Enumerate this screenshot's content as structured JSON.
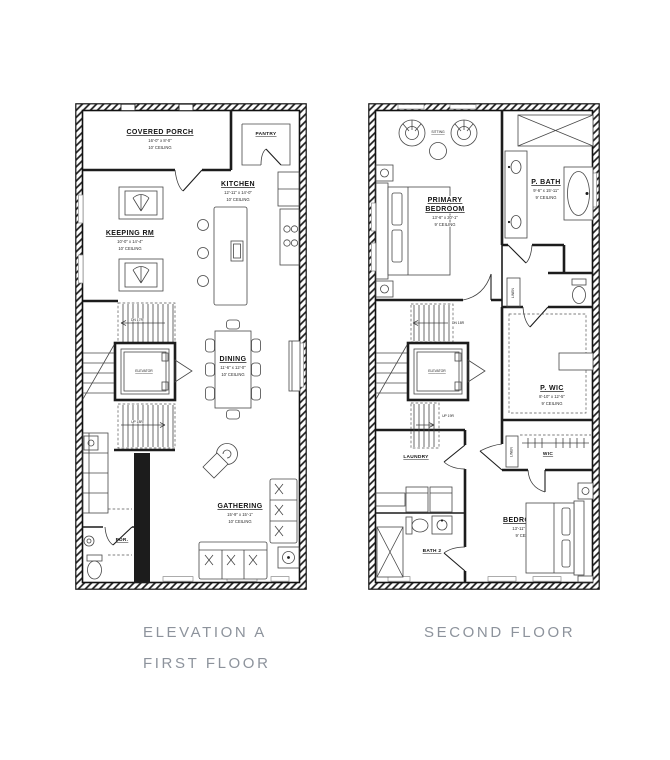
{
  "captions": {
    "elevation": "ELEVATION A",
    "first_floor": "FIRST FLOOR",
    "second_floor": "SECOND FLOOR",
    "color": "#8d939c"
  },
  "colors": {
    "line": "#1c1c1c",
    "background": "#ffffff"
  },
  "first_floor": {
    "covered_porch": {
      "name": "COVERED PORCH",
      "dims": "16'-0\" x 8'-0\"",
      "ceiling": "10' CEILING"
    },
    "pantry": {
      "name": "PANTRY"
    },
    "kitchen": {
      "name": "KITCHEN",
      "dims": "12'-11\" x 14'-0\"",
      "ceiling": "10' CEILING"
    },
    "keeping": {
      "name": "KEEPING RM",
      "dims": "10'-0\" x 14'-4\"",
      "ceiling": "10' CEILING"
    },
    "elevator": {
      "name": "ELEVATOR"
    },
    "stairs_dn": "DN 17R",
    "stairs_up": "UP 18R",
    "dining": {
      "name": "DINING",
      "dims": "11'-6\" x 12'-0\"",
      "ceiling": "10' CEILING"
    },
    "gathering": {
      "name": "GATHERING",
      "dims": "15'-9\" x 15'-1\"",
      "ceiling": "10' CEILING"
    },
    "powder": {
      "name": "PDR."
    }
  },
  "second_floor": {
    "sitting": {
      "name": "SITTING"
    },
    "primary": {
      "line1": "PRIMARY",
      "line2": "BEDROOM",
      "dims": "13'-6\" x 20'-1\"",
      "ceiling": "9' CEILING"
    },
    "p_bath": {
      "name": "P. BATH",
      "dims": "9'-6\" x 15'-11\"",
      "ceiling": "9' CEILING"
    },
    "elevator": {
      "name": "ELEVATOR"
    },
    "stairs_dn": "DN 18R",
    "stairs_up": "UP 19R",
    "p_wic": {
      "name": "P. WIC",
      "dims": "8'-10\" x 12'-5\"",
      "ceiling": "9' CEILING"
    },
    "laundry": {
      "name": "LAUNDRY"
    },
    "linen": {
      "name": "LINEN"
    },
    "wic": {
      "name": "WIC"
    },
    "bath2": {
      "name": "BATH 2"
    },
    "bedroom2": {
      "name": "BEDROOM 2",
      "dims": "13'-11\" x 11'-9\"",
      "ceiling": "9' CEILING"
    }
  }
}
